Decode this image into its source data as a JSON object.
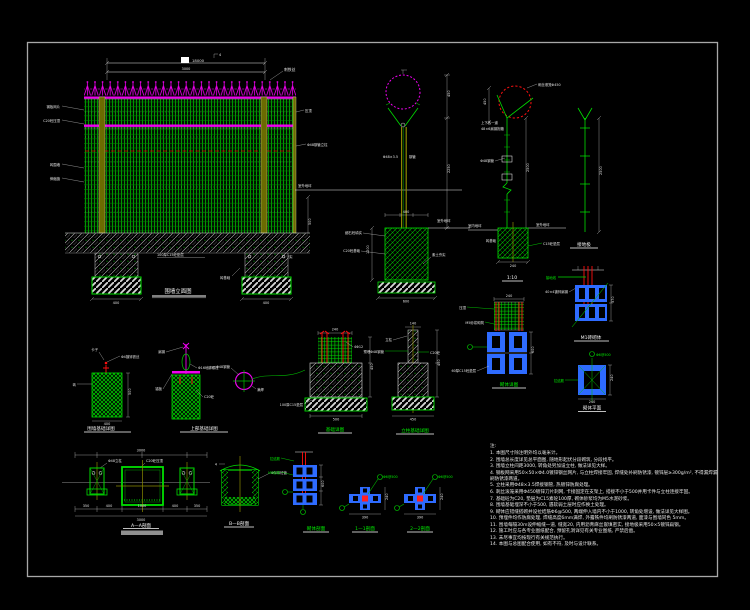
{
  "colors": {
    "bg": "#000000",
    "frame": "#a8a8a8",
    "green": "#00e000",
    "magenta": "#ee00ee",
    "red": "#ff1010",
    "blue": "#2e6bff",
    "white": "#e6e6e6",
    "olive": "#8a8a00"
  },
  "captions": {
    "fence": "围墙立面图",
    "post_right": "1:10",
    "rod": "接地极",
    "m1": "M1砖砌体",
    "small_plan": "砌体平面",
    "block": "砌体详图",
    "found_a": "围墙基础详图",
    "found_b": "上部基础详图",
    "found_d": "基础详图",
    "found_e": "立柱基础详图",
    "aa": "A—A剖面",
    "bb": "B—B剖面",
    "sec": "砌体剖面",
    "plan1": "1—1剖面",
    "plan2": "2—2剖面"
  },
  "labels": {
    "fence_spike": "刺铁丝",
    "fence_l1": "钢板网片",
    "fence_l2": "C20砼压顶",
    "fence_l3": "砖围墙",
    "fence_l4": "伸缩缝",
    "fence_r1": "压顶",
    "fence_r2": "Φ48钢管立柱",
    "fence_r3": "室外地坪",
    "fence_g1": "100厚C15砼垫层",
    "fence_g2": "砖基础",
    "fence_g3": "素土夯实",
    "postmid_pipe_l": "Φ48×3.5",
    "postmid_pipe_r": "钢管",
    "postmid_fill": "细石砼填实",
    "postmid_base": "C20砼基础",
    "postmid_ground": "室外地坪",
    "postmid_soil": "素土夯实",
    "postright_cage": "刺丝滚笼Φ450",
    "postright_clamp1": "上下各一道",
    "postright_clamp2": "48×6扁钢抱箍",
    "postright_pipe": "Φ48钢管",
    "postright_floor_in": "室内地坪",
    "postright_ground": "室外地坪",
    "postright_brick": "砖基础",
    "postright_cushion": "C15砼垫层",
    "m1_wire": "接地线",
    "m1_embed": "40×4镀锌扁钢",
    "block_cap": "压顶",
    "block_mortar": "M5砂浆砌筑",
    "block_cushion": "60厚C15砼垫层",
    "small_tie": "拉结筋",
    "small_bar": "Φ6@500",
    "fa_l1": "卡子",
    "fa_l2": "Φ4镀锌铁丝",
    "fa_l3": "砖",
    "fb_steel": "扁钢",
    "fb_bolt": "Φ16地脚螺栓",
    "fb_plate": "锚板",
    "fb_conc": "C20砼",
    "fc_pipe": "Φ48钢管",
    "fc_weld": "满焊",
    "fd_bars": "4Φ12",
    "fd_cushion": "100厚C15垫层",
    "fe_post": "立柱",
    "fe_embed": "预埋Φ48钢管",
    "fe_conc": "C20砼",
    "aa_l1": "Φ48立柱",
    "aa_l2": "C20砼压顶",
    "bb_pipe": "Φ300砼管",
    "bb_tick": "4",
    "sec_tie": "拉结筋",
    "sec_mortar": "M5砂浆",
    "p1_bar": "Φ6@500",
    "p2_bar": "Φ6@500"
  },
  "dims": {
    "fence_total": "18000",
    "fence_seg": "3000",
    "fence_tick": "4",
    "fence_h": "500",
    "footL": "400",
    "footR": "400",
    "pm_h1": "450",
    "pm_h2": "2250",
    "pm_embed": "1200",
    "pm_top": "400",
    "pm_bot": "600",
    "pr_arm": "450",
    "pr_h": "2500",
    "pr_foot": "240",
    "rod_len": "2500",
    "m1_h": "370",
    "blk_top": "240",
    "blk_h": "600",
    "sm_w": "240",
    "sm_b": "240",
    "fa_h": "500",
    "fa_w": "400",
    "fd_top": "240",
    "fd_h": "450",
    "fd_w": "500",
    "fe_top": "140",
    "fe_h": "400",
    "fe_w": "450",
    "aa_top": "3000",
    "aa_s1": "350",
    "aa_s2": "400",
    "aa_s3": "1000",
    "aa_s4": "400",
    "aa_s5": "350",
    "aa_bot": "3000",
    "sec_h": "600",
    "p1_w": "390",
    "p1_h": "240",
    "p2_w": "390",
    "p2_h": "240"
  },
  "notes": {
    "title": "注:",
    "lines": [
      "1. 本图尺寸除注明外均以毫米计。",
      "2. 围墙总长度详见总平面图, 随地形起伏分段砌筑, 分段找平。",
      "3. 围墙立柱间距3000, 转角处另加设立柱, 做法详见大样。",
      "4. 钢板网采用50×50×Φ4.0镀锌钢丝网片, 与立柱焊接牢固, 焊缝处补刷防锈漆, 镀锌层≥300g/m², 不得漏焊漏刷防锈漆两道。",
      "5. 立柱采用Φ48×3.5焊接钢管, 热镀锌防腐处理。",
      "6. 刺丝滚笼采用Φ450镀锌刀片刺网, 卡接固定在支架上, 搭接不小于500并用卡件与立柱连接牢固。",
      "7. 基础砼为C20, 垫层为C15素砼100厚, 砌体砂浆均为M5水泥砂浆。",
      "8. 围墙基础埋深不小于500, 遇软弱土层时应作换土处理。",
      "9. 砌体应错缝搭砌并设拉结筋Φ6@500, 两端伸入墙内不小于1000, 转角处增设, 做法详见大样图。",
      "10. 预埋件均作防腐处理, 焊缝高度6mm满焊, 外露铁件均刷防锈漆两道, 面漆与围墙同色 5mm。",
      "11. 围墙每隔30m设伸缩缝一道, 缝宽20, 内用沥青麻丝嵌填密实, 接地极采用50×5镀锌扁钢。",
      "12. 施工时应与各专业图纸配合, 预留孔洞详见有关专业图纸, 严禁后凿。",
      "13. 未尽事宜均按现行有关规范执行。",
      "14. 本图与总图配合使用, 如有不符, 及时与设计联系。"
    ]
  }
}
